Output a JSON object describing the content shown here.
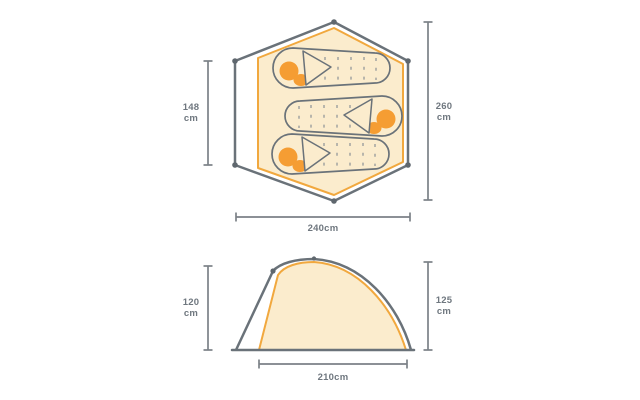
{
  "colors": {
    "outline": "#6a7279",
    "accent": "#f1a83e",
    "cream": "#fbeccd",
    "orange": "#f59d33",
    "dim": "#7b8187",
    "text": "#6f777f",
    "dash": "#8b9196",
    "background": "#ffffff"
  },
  "top_view": {
    "inner_width_dim": {
      "value": "148",
      "unit": "cm"
    },
    "outer_length_dim": {
      "value": "260",
      "unit": "cm"
    },
    "outer_width_dim": {
      "label": "240cm"
    }
  },
  "side_view": {
    "inner_height_dim": {
      "value": "120",
      "unit": "cm"
    },
    "outer_height_dim": {
      "value": "125",
      "unit": "cm"
    },
    "floor_length_dim": {
      "label": "210cm"
    }
  }
}
